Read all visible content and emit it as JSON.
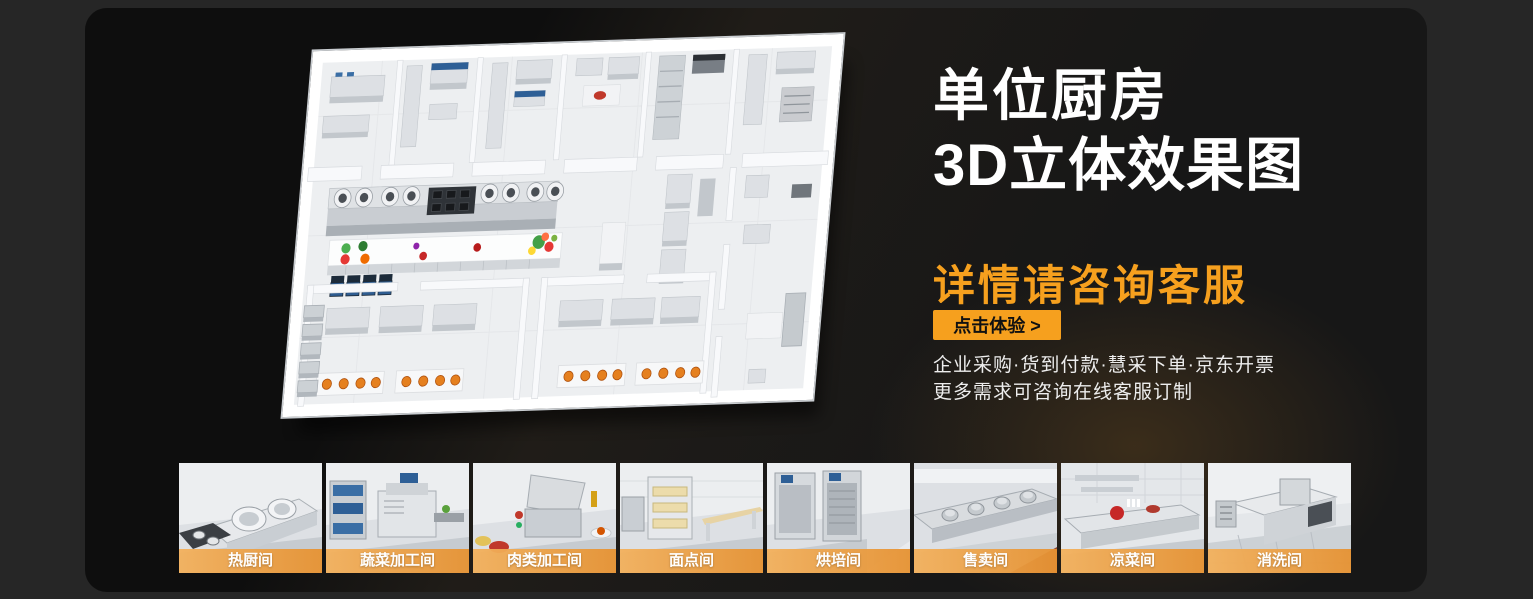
{
  "theme": {
    "accent_orange": "#F6A01E",
    "label_bar_orange": "#ED9A3C",
    "panel_bg": "#171717",
    "outer_bg": "#262626",
    "title_color": "#FFFFFF"
  },
  "hero": {
    "title_line1": "单位厨房",
    "title_line2": "3D立体效果图",
    "subtitle": "详情请咨询客服",
    "cta_label": "点击体验 >",
    "feature_line1": "企业采购·货到付款·慧采下单·京东开票",
    "feature_line2": "更多需求可咨询在线客服订制"
  },
  "thumbnails": [
    {
      "label": "热厨间"
    },
    {
      "label": "蔬菜加工间"
    },
    {
      "label": "肉类加工间"
    },
    {
      "label": "面点间"
    },
    {
      "label": "烘培间"
    },
    {
      "label": "售卖间"
    },
    {
      "label": "凉菜间"
    },
    {
      "label": "消洗间"
    }
  ]
}
